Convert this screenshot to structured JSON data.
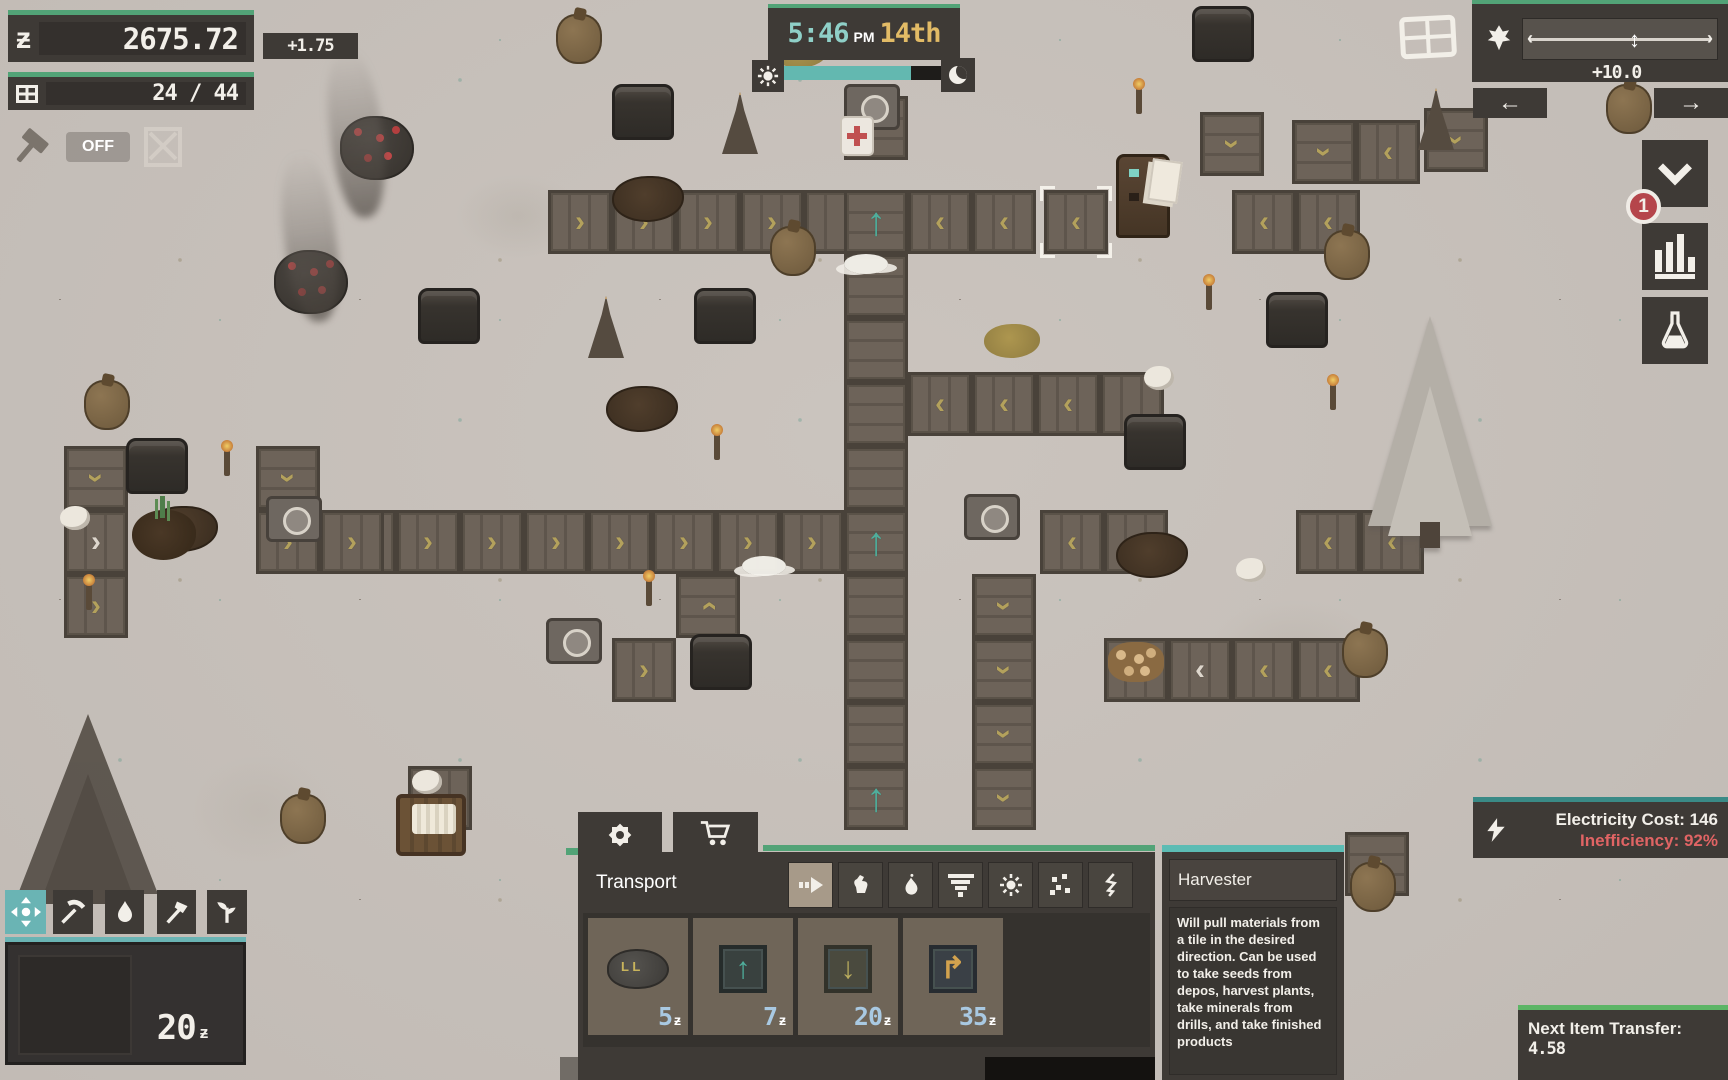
{
  "hud": {
    "currency": {
      "value": "2675.72",
      "delta": "+1.75",
      "symbol": "ƶ"
    },
    "capacity": {
      "value": "24 / 44"
    },
    "autobuild": {
      "label": "OFF"
    },
    "clock": {
      "time": "5:46",
      "meridiem": "PM",
      "day": "14th",
      "day_progress": 0.81
    },
    "speed": {
      "value": "+10.0",
      "handle_pos": 0.58,
      "cap_left": "‹",
      "cap_right": "›",
      "handle_glyph": "↕",
      "nav_left": "←",
      "nav_right": "→"
    },
    "alerts": {
      "count": "1"
    },
    "electricity": {
      "cost_label": "Electricity Cost: 146",
      "inefficiency_label": "Inefficiency: 92%"
    },
    "next_transfer": {
      "label": "Next Item Transfer:",
      "value": "4.58"
    },
    "wallet": {
      "value": "20",
      "symbol": "ƶ"
    }
  },
  "store": {
    "category_title": "Transport",
    "currency_symbol": "ƶ",
    "items": [
      {
        "name": "conveyor-pile",
        "price": "5"
      },
      {
        "name": "harvester-up",
        "price": "7",
        "glyph": "↑"
      },
      {
        "name": "inserter-down",
        "price": "20",
        "glyph": "↓"
      },
      {
        "name": "underground-turn",
        "price": "35",
        "glyph": "↱"
      }
    ]
  },
  "tooltip": {
    "title": "Harvester",
    "description": "Will pull materials from a tile in the desired direction. Can be used to take seeds from depos, harvest plants, take minerals from drills, and take finished products"
  },
  "colors": {
    "green": "#52a377",
    "teal": "#63b8b0",
    "tooltip-teal": "#5cbcb4",
    "elec-teal": "#3a8a86",
    "next-green": "#5cb566",
    "price-blue": "#a9c9e2",
    "warn-red": "#e06464",
    "badge-red": "#b5454b",
    "gold": "#e2bb66",
    "time-teal": "#8fd0c8",
    "chev-gold": "#b3a15c",
    "belt-teal": "#4fae9c",
    "toolbar-teal": "#6ab4b4",
    "panel": "#3e3a36",
    "panel-dark": "#35322e",
    "card": "#6f6558",
    "ground": "#cbc4be"
  },
  "map": {
    "belts": [
      {
        "x": 548,
        "y": 190,
        "d": "r"
      },
      {
        "x": 612,
        "y": 190,
        "d": "r"
      },
      {
        "x": 676,
        "y": 190,
        "d": "r"
      },
      {
        "x": 740,
        "y": 190,
        "d": "r"
      },
      {
        "x": 804,
        "y": 190,
        "d": "p"
      },
      {
        "x": 844,
        "y": 190,
        "d": "u",
        "v": "t"
      },
      {
        "x": 908,
        "y": 190,
        "d": "l"
      },
      {
        "x": 972,
        "y": 190,
        "d": "l"
      },
      {
        "x": 1044,
        "y": 190,
        "d": "l",
        "sel": true
      },
      {
        "x": 1232,
        "y": 190,
        "d": "l"
      },
      {
        "x": 1296,
        "y": 190,
        "d": "l"
      },
      {
        "x": 844,
        "y": 96,
        "d": "p"
      },
      {
        "x": 844,
        "y": 254,
        "d": "p"
      },
      {
        "x": 844,
        "y": 318,
        "d": "p"
      },
      {
        "x": 844,
        "y": 382,
        "d": "p"
      },
      {
        "x": 844,
        "y": 446,
        "d": "p"
      },
      {
        "x": 844,
        "y": 510,
        "d": "u",
        "v": "t"
      },
      {
        "x": 844,
        "y": 574,
        "d": "p"
      },
      {
        "x": 844,
        "y": 638,
        "d": "p"
      },
      {
        "x": 844,
        "y": 702,
        "d": "p"
      },
      {
        "x": 844,
        "y": 766,
        "d": "u",
        "v": "t"
      },
      {
        "x": 332,
        "y": 510,
        "d": "r"
      },
      {
        "x": 396,
        "y": 510,
        "d": "r"
      },
      {
        "x": 460,
        "y": 510,
        "d": "r"
      },
      {
        "x": 524,
        "y": 510,
        "d": "r"
      },
      {
        "x": 588,
        "y": 510,
        "d": "r"
      },
      {
        "x": 652,
        "y": 510,
        "d": "r"
      },
      {
        "x": 716,
        "y": 510,
        "d": "r"
      },
      {
        "x": 780,
        "y": 510,
        "d": "r"
      },
      {
        "x": 1040,
        "y": 510,
        "d": "l"
      },
      {
        "x": 1104,
        "y": 510,
        "d": "p"
      },
      {
        "x": 1296,
        "y": 510,
        "d": "l"
      },
      {
        "x": 1360,
        "y": 510,
        "d": "l"
      },
      {
        "x": 908,
        "y": 372,
        "d": "l"
      },
      {
        "x": 972,
        "y": 372,
        "d": "l"
      },
      {
        "x": 1036,
        "y": 372,
        "d": "l"
      },
      {
        "x": 1100,
        "y": 372,
        "d": "p"
      },
      {
        "x": 1104,
        "y": 638,
        "d": "p"
      },
      {
        "x": 1168,
        "y": 638,
        "d": "l",
        "v": "w"
      },
      {
        "x": 1232,
        "y": 638,
        "d": "l"
      },
      {
        "x": 1296,
        "y": 638,
        "d": "l"
      },
      {
        "x": 972,
        "y": 574,
        "d": "d"
      },
      {
        "x": 972,
        "y": 638,
        "d": "d"
      },
      {
        "x": 972,
        "y": 702,
        "d": "d"
      },
      {
        "x": 972,
        "y": 766,
        "d": "d"
      },
      {
        "x": 64,
        "y": 446,
        "d": "d"
      },
      {
        "x": 256,
        "y": 446,
        "d": "d"
      },
      {
        "x": 64,
        "y": 510,
        "d": "r",
        "v": "w"
      },
      {
        "x": 256,
        "y": 510,
        "d": "r"
      },
      {
        "x": 320,
        "y": 510,
        "d": "r"
      },
      {
        "x": 64,
        "y": 574,
        "d": "r"
      },
      {
        "x": 676,
        "y": 574,
        "d": "u"
      },
      {
        "x": 612,
        "y": 638,
        "d": "r"
      },
      {
        "x": 1200,
        "y": 112,
        "d": "d"
      },
      {
        "x": 1292,
        "y": 120,
        "d": "d"
      },
      {
        "x": 1356,
        "y": 120,
        "d": "l"
      },
      {
        "x": 1424,
        "y": 108,
        "d": "d"
      },
      {
        "x": 1345,
        "y": 832,
        "d": "d"
      },
      {
        "x": 408,
        "y": 766,
        "d": "p"
      }
    ],
    "props": [
      {
        "t": "pot",
        "x": 612,
        "y": 84
      },
      {
        "t": "pot",
        "x": 418,
        "y": 288
      },
      {
        "t": "pot",
        "x": 694,
        "y": 288
      },
      {
        "t": "pot",
        "x": 126,
        "y": 438
      },
      {
        "t": "pot",
        "x": 1266,
        "y": 292
      },
      {
        "t": "pot",
        "x": 1192,
        "y": 6
      },
      {
        "t": "pot",
        "x": 690,
        "y": 634
      },
      {
        "t": "pot",
        "x": 1124,
        "y": 414
      },
      {
        "t": "derrick",
        "x": 722,
        "y": 92
      },
      {
        "t": "derrick",
        "x": 588,
        "y": 296
      },
      {
        "t": "derrick",
        "x": 1418,
        "y": 88
      },
      {
        "t": "torch",
        "x": 224,
        "y": 450
      },
      {
        "t": "torch",
        "x": 86,
        "y": 584
      },
      {
        "t": "torch",
        "x": 646,
        "y": 580
      },
      {
        "t": "torch",
        "x": 714,
        "y": 434
      },
      {
        "t": "torch",
        "x": 1136,
        "y": 88
      },
      {
        "t": "torch",
        "x": 1206,
        "y": 284
      },
      {
        "t": "torch",
        "x": 1330,
        "y": 384
      },
      {
        "t": "sack",
        "x": 556,
        "y": 14
      },
      {
        "t": "sack",
        "x": 770,
        "y": 226
      },
      {
        "t": "sack",
        "x": 84,
        "y": 380
      },
      {
        "t": "sack",
        "x": 1324,
        "y": 230
      },
      {
        "t": "sack",
        "x": 1606,
        "y": 84
      },
      {
        "t": "sack",
        "x": 1342,
        "y": 628
      },
      {
        "t": "sack",
        "x": 1350,
        "y": 862
      },
      {
        "t": "sack",
        "x": 280,
        "y": 794
      },
      {
        "t": "tree-snow",
        "x": 1368,
        "y": 316
      },
      {
        "t": "tree-dead",
        "x": 18,
        "y": 714
      },
      {
        "t": "tree-berry",
        "x": 340,
        "y": 116
      },
      {
        "t": "tree-berry",
        "x": 274,
        "y": 250
      },
      {
        "t": "smoke",
        "x": 330,
        "y": 48
      },
      {
        "t": "smoke",
        "x": 284,
        "y": 152
      },
      {
        "t": "dirt",
        "x": 146,
        "y": 506
      },
      {
        "t": "dirt",
        "x": 606,
        "y": 386
      },
      {
        "t": "dirt",
        "x": 1116,
        "y": 532
      },
      {
        "t": "dirt",
        "x": 1260,
        "y": 878
      },
      {
        "t": "dirt",
        "x": 612,
        "y": 176
      },
      {
        "t": "golddirt",
        "x": 984,
        "y": 324
      },
      {
        "t": "golddirt",
        "x": 772,
        "y": 34
      },
      {
        "t": "flour",
        "x": 60,
        "y": 506
      },
      {
        "t": "flour",
        "x": 1144,
        "y": 366
      },
      {
        "t": "flour",
        "x": 412,
        "y": 770
      },
      {
        "t": "flour",
        "x": 1236,
        "y": 558
      },
      {
        "t": "cloud",
        "x": 742,
        "y": 556
      },
      {
        "t": "cloud",
        "x": 844,
        "y": 254
      },
      {
        "t": "sprout",
        "x": 132,
        "y": 510
      },
      {
        "t": "robot",
        "x": 1116,
        "y": 154
      },
      {
        "t": "gizmo",
        "x": 546,
        "y": 618
      },
      {
        "t": "gizmo",
        "x": 964,
        "y": 494
      },
      {
        "t": "gizmo",
        "x": 266,
        "y": 496
      },
      {
        "t": "gizmo",
        "x": 844,
        "y": 84
      },
      {
        "t": "papers",
        "x": 1150,
        "y": 160
      },
      {
        "t": "medkit",
        "x": 840,
        "y": 116
      },
      {
        "t": "cart",
        "x": 396,
        "y": 794
      },
      {
        "t": "cookie",
        "x": 1108,
        "y": 642
      }
    ]
  }
}
